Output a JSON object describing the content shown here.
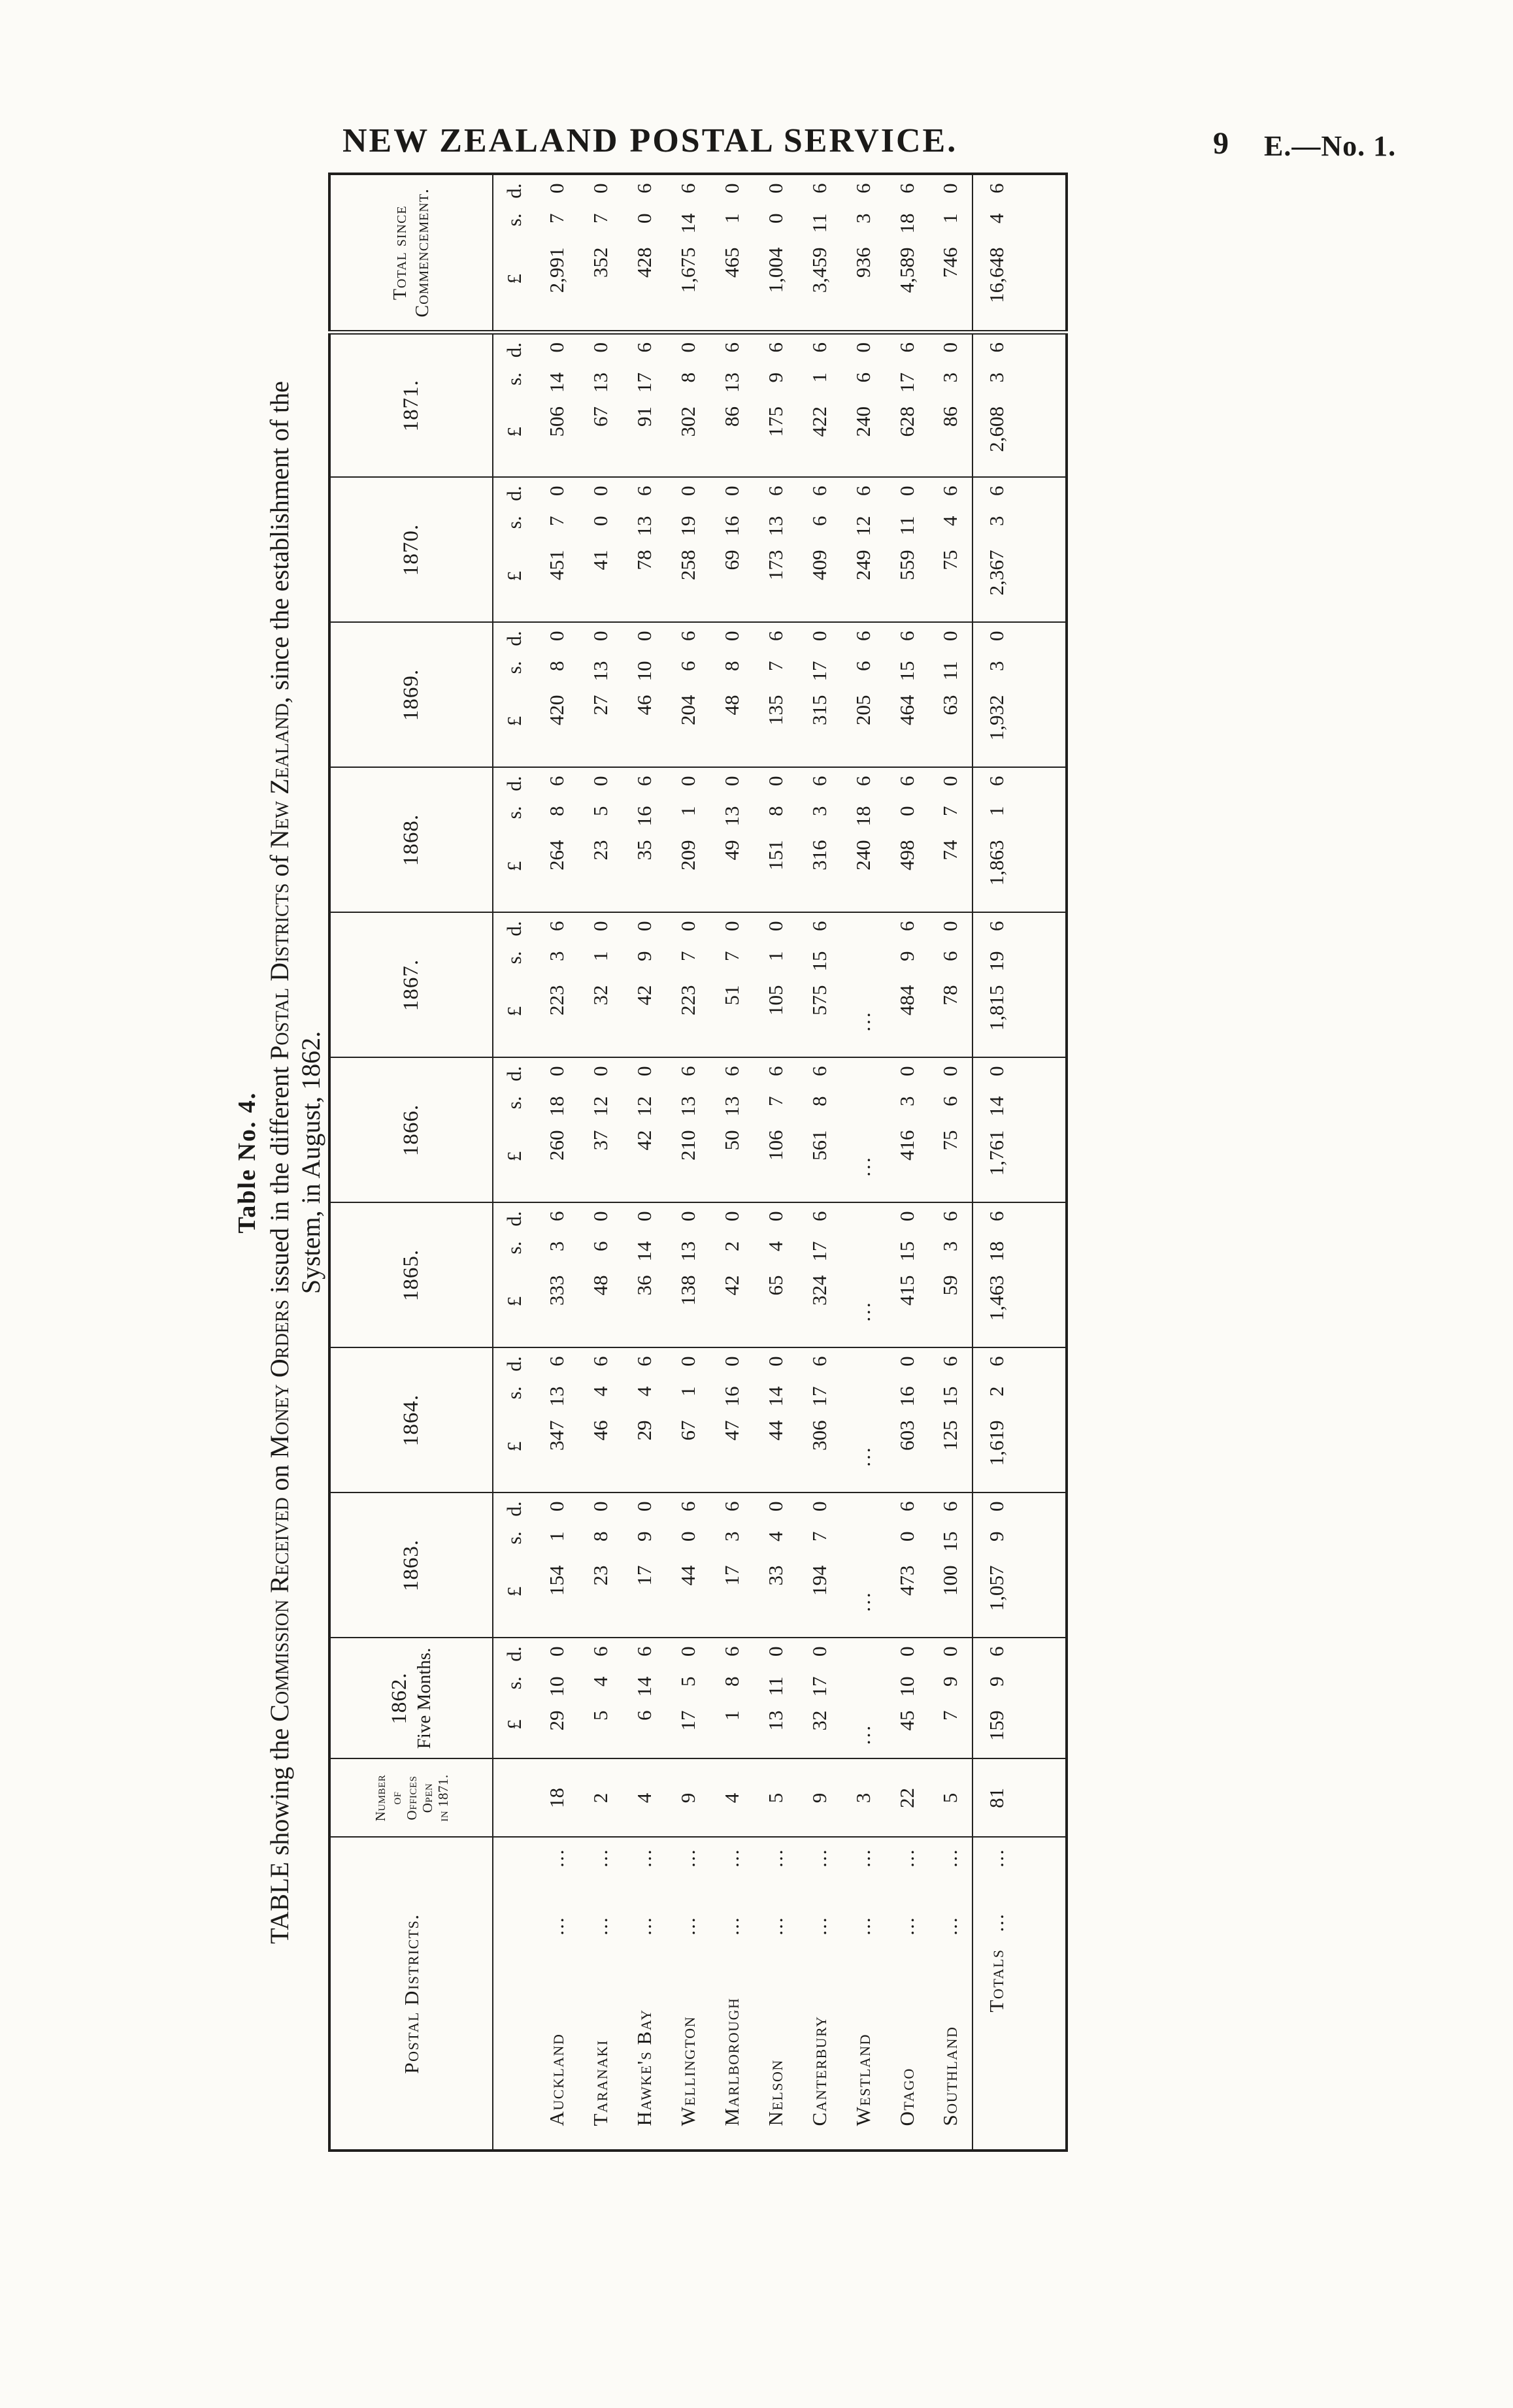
{
  "page": {
    "title": "NEW ZEALAND POSTAL SERVICE.",
    "page_number": "9",
    "paper_ref": "E.—No. 1."
  },
  "table_label": "Table No. 4.",
  "caption": {
    "line1_segments": [
      {
        "text": "TABLE showing the ",
        "smallcaps": false
      },
      {
        "text": "Commission Received",
        "smallcaps": true
      },
      {
        "text": " on ",
        "smallcaps": false
      },
      {
        "text": "Money Orders",
        "smallcaps": true
      },
      {
        "text": " issued in the different ",
        "smallcaps": false
      },
      {
        "text": "Postal Districts",
        "smallcaps": true
      },
      {
        "text": " of ",
        "smallcaps": false
      },
      {
        "text": "New Zealand",
        "smallcaps": true
      },
      {
        "text": ", since the establishment of the",
        "smallcaps": false
      }
    ],
    "line2": "System, in August, 1862."
  },
  "table": {
    "headers": {
      "districts": "Postal Districts.",
      "offices_lines": [
        "Number",
        "of",
        "Offices",
        "Open",
        "in 1871."
      ],
      "col_1862_lines": [
        "1862.",
        "Five Months."
      ],
      "years": [
        "1863.",
        "1864.",
        "1865.",
        "1866.",
        "1867.",
        "1868.",
        "1869.",
        "1870.",
        "1871."
      ],
      "total_lines": [
        "Total since",
        "Commencement."
      ],
      "money_units": [
        "£",
        "s.",
        "d."
      ]
    },
    "leader_dots": "...",
    "ellipsis": "...",
    "rows": [
      {
        "district": "Auckland",
        "offices": "18",
        "values": [
          [
            "29",
            "10",
            "0"
          ],
          [
            "154",
            "1",
            "0"
          ],
          [
            "347",
            "13",
            "6"
          ],
          [
            "333",
            "3",
            "6"
          ],
          [
            "260",
            "18",
            "0"
          ],
          [
            "223",
            "3",
            "6"
          ],
          [
            "264",
            "8",
            "6"
          ],
          [
            "420",
            "8",
            "0"
          ],
          [
            "451",
            "7",
            "0"
          ],
          [
            "506",
            "14",
            "0"
          ],
          [
            "2,991",
            "7",
            "0"
          ]
        ]
      },
      {
        "district": "Taranaki",
        "offices": "2",
        "values": [
          [
            "5",
            "4",
            "6"
          ],
          [
            "23",
            "8",
            "0"
          ],
          [
            "46",
            "4",
            "6"
          ],
          [
            "48",
            "6",
            "0"
          ],
          [
            "37",
            "12",
            "0"
          ],
          [
            "32",
            "1",
            "0"
          ],
          [
            "23",
            "5",
            "0"
          ],
          [
            "27",
            "13",
            "0"
          ],
          [
            "41",
            "0",
            "0"
          ],
          [
            "67",
            "13",
            "0"
          ],
          [
            "352",
            "7",
            "0"
          ]
        ]
      },
      {
        "district": "Hawke's Bay",
        "offices": "4",
        "values": [
          [
            "6",
            "14",
            "6"
          ],
          [
            "17",
            "9",
            "0"
          ],
          [
            "29",
            "4",
            "6"
          ],
          [
            "36",
            "14",
            "0"
          ],
          [
            "42",
            "12",
            "0"
          ],
          [
            "42",
            "9",
            "0"
          ],
          [
            "35",
            "16",
            "6"
          ],
          [
            "46",
            "10",
            "0"
          ],
          [
            "78",
            "13",
            "6"
          ],
          [
            "91",
            "17",
            "6"
          ],
          [
            "428",
            "0",
            "6"
          ]
        ]
      },
      {
        "district": "Wellington",
        "offices": "9",
        "values": [
          [
            "17",
            "5",
            "0"
          ],
          [
            "44",
            "0",
            "6"
          ],
          [
            "67",
            "1",
            "0"
          ],
          [
            "138",
            "13",
            "0"
          ],
          [
            "210",
            "13",
            "6"
          ],
          [
            "223",
            "7",
            "0"
          ],
          [
            "209",
            "1",
            "0"
          ],
          [
            "204",
            "6",
            "6"
          ],
          [
            "258",
            "19",
            "0"
          ],
          [
            "302",
            "8",
            "0"
          ],
          [
            "1,675",
            "14",
            "6"
          ]
        ]
      },
      {
        "district": "Marlborough",
        "offices": "4",
        "values": [
          [
            "1",
            "8",
            "6"
          ],
          [
            "17",
            "3",
            "6"
          ],
          [
            "47",
            "16",
            "0"
          ],
          [
            "42",
            "2",
            "0"
          ],
          [
            "50",
            "13",
            "6"
          ],
          [
            "51",
            "7",
            "0"
          ],
          [
            "49",
            "13",
            "0"
          ],
          [
            "48",
            "8",
            "0"
          ],
          [
            "69",
            "16",
            "0"
          ],
          [
            "86",
            "13",
            "6"
          ],
          [
            "465",
            "1",
            "0"
          ]
        ]
      },
      {
        "district": "Nelson",
        "offices": "5",
        "values": [
          [
            "13",
            "11",
            "0"
          ],
          [
            "33",
            "4",
            "0"
          ],
          [
            "44",
            "14",
            "0"
          ],
          [
            "65",
            "4",
            "0"
          ],
          [
            "106",
            "7",
            "6"
          ],
          [
            "105",
            "1",
            "0"
          ],
          [
            "151",
            "8",
            "0"
          ],
          [
            "135",
            "7",
            "6"
          ],
          [
            "173",
            "13",
            "6"
          ],
          [
            "175",
            "9",
            "6"
          ],
          [
            "1,004",
            "0",
            "0"
          ]
        ]
      },
      {
        "district": "Canterbury",
        "offices": "9",
        "values": [
          [
            "32",
            "17",
            "0"
          ],
          [
            "194",
            "7",
            "0"
          ],
          [
            "306",
            "17",
            "6"
          ],
          [
            "324",
            "17",
            "6"
          ],
          [
            "561",
            "8",
            "6"
          ],
          [
            "575",
            "15",
            "6"
          ],
          [
            "316",
            "3",
            "6"
          ],
          [
            "315",
            "17",
            "0"
          ],
          [
            "409",
            "6",
            "6"
          ],
          [
            "422",
            "1",
            "6"
          ],
          [
            "3,459",
            "11",
            "6"
          ]
        ]
      },
      {
        "district": "Westland",
        "offices": "3",
        "values": [
          null,
          null,
          null,
          null,
          null,
          null,
          [
            "240",
            "18",
            "6"
          ],
          [
            "205",
            "6",
            "6"
          ],
          [
            "249",
            "12",
            "6"
          ],
          [
            "240",
            "6",
            "0"
          ],
          [
            "936",
            "3",
            "6"
          ]
        ]
      },
      {
        "district": "Otago",
        "offices": "22",
        "values": [
          [
            "45",
            "10",
            "0"
          ],
          [
            "473",
            "0",
            "6"
          ],
          [
            "603",
            "16",
            "0"
          ],
          [
            "415",
            "15",
            "0"
          ],
          [
            "416",
            "3",
            "0"
          ],
          [
            "484",
            "9",
            "6"
          ],
          [
            "498",
            "0",
            "6"
          ],
          [
            "464",
            "15",
            "6"
          ],
          [
            "559",
            "11",
            "0"
          ],
          [
            "628",
            "17",
            "6"
          ],
          [
            "4,589",
            "18",
            "6"
          ]
        ]
      },
      {
        "district": "Southland",
        "offices": "5",
        "values": [
          [
            "7",
            "9",
            "0"
          ],
          [
            "100",
            "15",
            "6"
          ],
          [
            "125",
            "15",
            "6"
          ],
          [
            "59",
            "3",
            "6"
          ],
          [
            "75",
            "6",
            "0"
          ],
          [
            "78",
            "6",
            "0"
          ],
          [
            "74",
            "7",
            "0"
          ],
          [
            "63",
            "11",
            "0"
          ],
          [
            "75",
            "4",
            "6"
          ],
          [
            "86",
            "3",
            "0"
          ],
          [
            "746",
            "1",
            "0"
          ]
        ]
      }
    ],
    "totals": {
      "label": "Totals",
      "offices": "81",
      "values": [
        [
          "159",
          "9",
          "6"
        ],
        [
          "1,057",
          "9",
          "0"
        ],
        [
          "1,619",
          "2",
          "6"
        ],
        [
          "1,463",
          "18",
          "6"
        ],
        [
          "1,761",
          "14",
          "0"
        ],
        [
          "1,815",
          "19",
          "6"
        ],
        [
          "1,863",
          "1",
          "6"
        ],
        [
          "1,932",
          "3",
          "0"
        ],
        [
          "2,367",
          "3",
          "6"
        ],
        [
          "2,608",
          "3",
          "6"
        ],
        [
          "16,648",
          "4",
          "6"
        ]
      ]
    }
  }
}
